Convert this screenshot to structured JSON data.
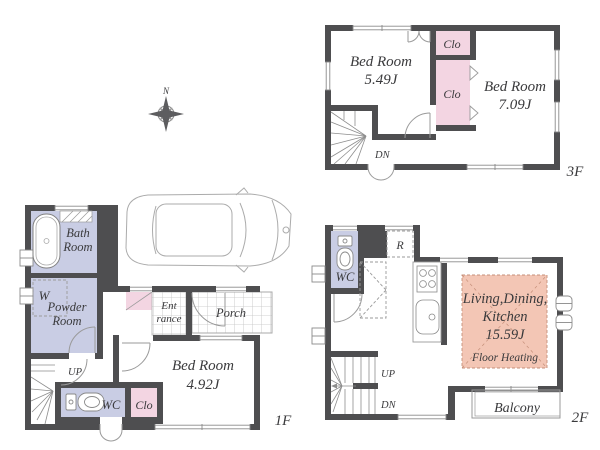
{
  "colors": {
    "wall": "#4e4e50",
    "room_lavender": "#c9cde4",
    "closet_pink": "#f3d5e2",
    "floor_heating": "#f3c6b5"
  },
  "compass": {
    "north": "N"
  },
  "floor3": {
    "label": "3F",
    "bedroom_left": {
      "name": "Bed Room",
      "size": "5.49J"
    },
    "bedroom_right": {
      "name": "Bed Room",
      "size": "7.09J"
    },
    "closet_top": "Clo",
    "closet_mid": "Clo",
    "stairs_down": "DN"
  },
  "floor1": {
    "label": "1F",
    "bath": {
      "line1": "Bath",
      "line2": "Room"
    },
    "washer": "W",
    "powder": {
      "line1": "Powder",
      "line2": "Room"
    },
    "entrance": {
      "line1": "Ent",
      "line2": "rance"
    },
    "porch": "Porch",
    "bedroom": {
      "name": "Bed Room",
      "size": "4.92J"
    },
    "wc": "WC",
    "closet": "Clo",
    "stairs_up": "UP"
  },
  "floor2": {
    "label": "2F",
    "wc": "WC",
    "refrigerator": "R",
    "ldk": {
      "line1": "Living,Dining,",
      "line2": "Kitchen",
      "size": "15.59J",
      "note": "Floor Heating"
    },
    "stairs_up": "UP",
    "stairs_down": "DN",
    "balcony": "Balcony"
  }
}
